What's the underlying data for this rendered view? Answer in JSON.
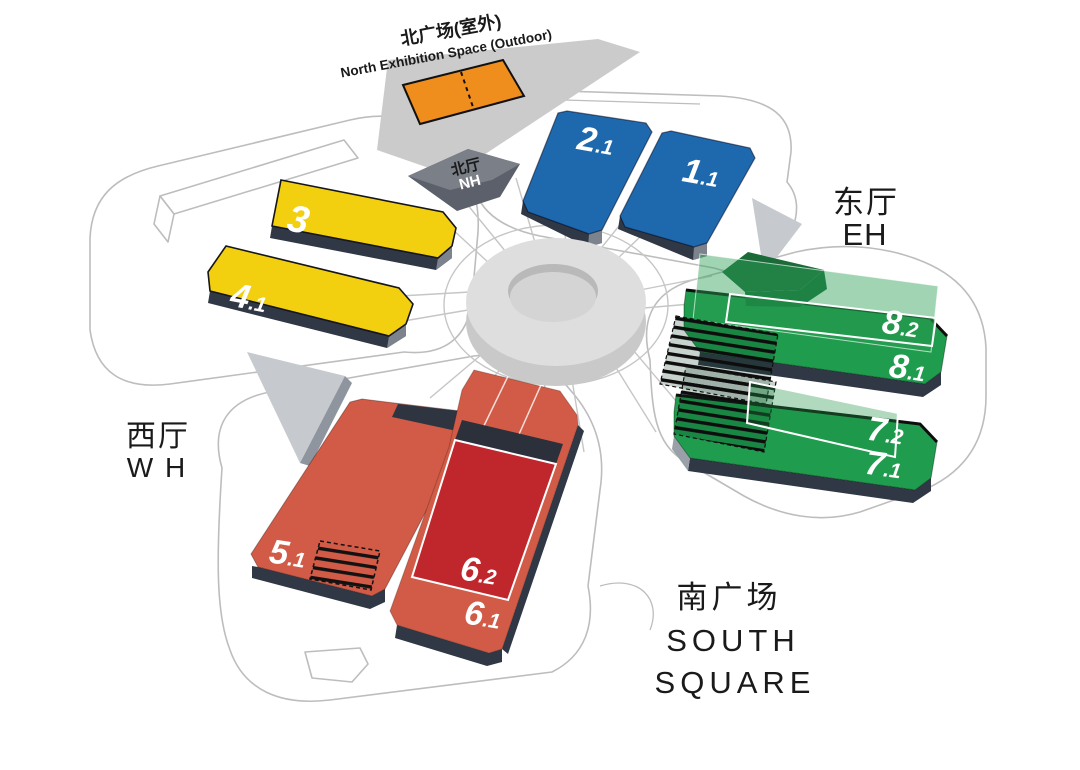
{
  "labels": {
    "north_outdoor": {
      "zh": "北广场(室外)",
      "en": "North Exhibition Space (Outdoor)"
    },
    "north_hall": {
      "zh": "北厅",
      "en": "NH"
    },
    "east_hall": {
      "zh": "东厅",
      "en": "EH"
    },
    "west_hall": {
      "zh": "西厅",
      "en": "W H"
    },
    "south_square": {
      "zh": "南广场",
      "en1": "SOUTH",
      "en2": "SQUARE"
    }
  },
  "halls": {
    "h1_1": {
      "major": "1",
      "minor": ".1"
    },
    "h2_1": {
      "major": "2",
      "minor": ".1"
    },
    "h3": {
      "major": "3",
      "minor": ""
    },
    "h4_1": {
      "major": "4",
      "minor": ".1"
    },
    "h5_1": {
      "major": "5",
      "minor": ".1"
    },
    "h6_1": {
      "major": "6",
      "minor": ".1"
    },
    "h6_2": {
      "major": "6",
      "minor": ".2"
    },
    "h7_1": {
      "major": "7",
      "minor": ".1"
    },
    "h7_2": {
      "major": "7",
      "minor": ".2"
    },
    "h8_1": {
      "major": "8",
      "minor": ".1"
    },
    "h8_2": {
      "major": "8",
      "minor": ".2"
    }
  },
  "colors": {
    "blue": "#1E68AE",
    "yellow": "#F2CF0F",
    "green": "#1F9C4D",
    "green_deep": "#156B37",
    "red": "#D15B47",
    "red_dark": "#C0272D",
    "orange": "#EF8D1D",
    "skirt": "#303845",
    "strip": "#CBCBCB",
    "outline": "#BDBDBD",
    "text": "#1A1A1A"
  }
}
